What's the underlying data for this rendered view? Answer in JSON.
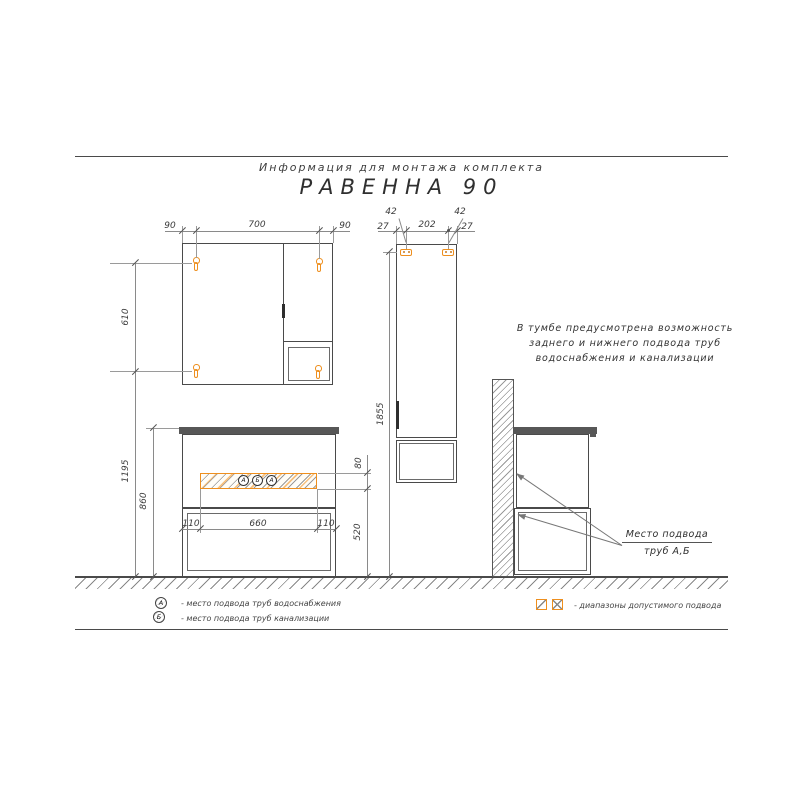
{
  "title": {
    "subtitle": "Информация для монтажа комплекта",
    "main": "РАВЕННА  90"
  },
  "dims": {
    "mirror_top": [
      "90",
      "700",
      "90"
    ],
    "mirror_mount_span": "610",
    "mount_height": "1195",
    "vanity_height": "860",
    "vanity_bottom": [
      "110",
      "660",
      "110"
    ],
    "zone_height": "80",
    "zone_floor": "520",
    "tall_top": [
      "27",
      "202",
      "27"
    ],
    "tall_bracket": [
      "42",
      "42"
    ],
    "tall_mount_height": "1855"
  },
  "ports": [
    "А",
    "Б",
    "А"
  ],
  "note_lines": [
    "В тумбе предусмотрена возможность",
    "заднего и нижнего подвода труб",
    "водоснабжения и канализации"
  ],
  "callout": {
    "line1": "Место подвода",
    "line2": "труб  А,Б"
  },
  "legend": {
    "water_symbol": "А",
    "water_text": "-  место подвода труб водоснабжения",
    "sewer_symbol": "Б",
    "sewer_text": "-  место подвода труб канализации",
    "ranges_text": "-  диапазоны допустимого подвода"
  },
  "colors": {
    "accent": "#ee8f1e",
    "line": "#4a4a4a"
  }
}
